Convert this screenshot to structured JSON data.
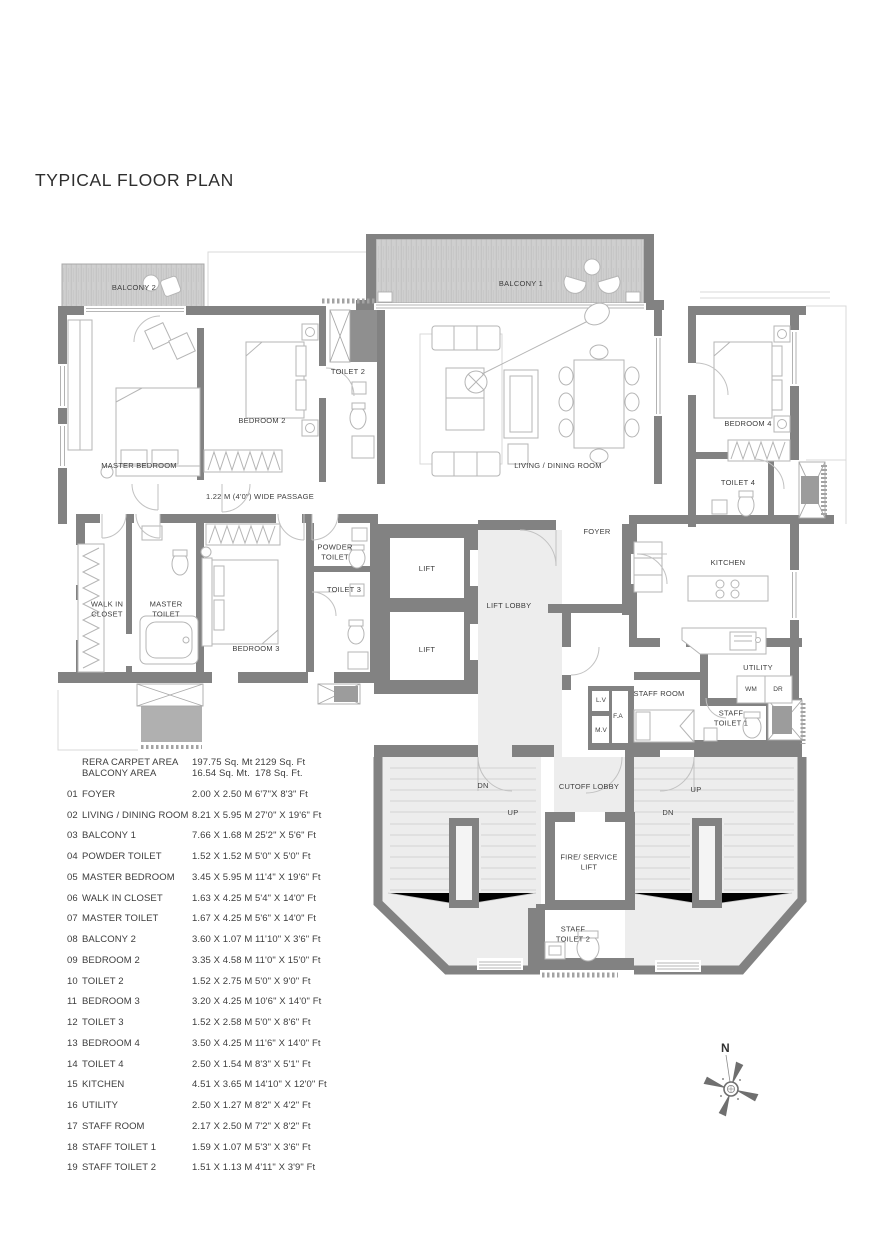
{
  "title": "TYPICAL FLOOR PLAN",
  "plan": {
    "labels": {
      "balcony2": "BALCONY 2",
      "balcony1": "BALCONY 1",
      "master_bedroom": "MASTER BEDROOM",
      "bedroom2": "BEDROOM 2",
      "toilet2": "TOILET 2",
      "living_dining": "LIVING / DINING ROOM",
      "bedroom4": "BEDROOM 4",
      "toilet4": "TOILET 4",
      "passage": "1.22 M (4'0\") WIDE PASSAGE",
      "foyer": "FOYER",
      "kitchen": "KITCHEN",
      "walk_in_closet": "WALK IN CLOSET",
      "master_toilet": "MASTER TOILET",
      "bedroom3": "BEDROOM 3",
      "powder_toilet": "POWDER TOILET",
      "toilet3": "TOILET 3",
      "lift1": "LIFT",
      "lift2": "LIFT",
      "lift_lobby": "LIFT LOBBY",
      "staff_room": "STAFF ROOM",
      "lv": "L.V",
      "fa": "F.A",
      "mv": "M.V",
      "utility": "UTILITY",
      "wm": "WM",
      "dr": "DR",
      "staff_toilet1": "STAFF TOILET 1",
      "cutoff_lobby": "CUTOFF LOBBY",
      "fire_service_lift": "FIRE/ SERVICE LIFT",
      "staff_toilet2": "STAFF TOILET 2",
      "stair_left_dn": "DN",
      "stair_left_up": "UP",
      "stair_right_up": "UP",
      "stair_right_dn": "DN"
    },
    "compass_north": "N"
  },
  "area_summary": [
    {
      "label": "RERA CARPET AREA",
      "metric": "197.75 Sq. Mt",
      "imperial": "2129 Sq. Ft"
    },
    {
      "label": "BALCONY AREA",
      "metric": "16.54 Sq. Mt.",
      "imperial": "178 Sq. Ft."
    }
  ],
  "rooms": [
    {
      "no": "01",
      "name": "FOYER",
      "metric": "2.00 X 2.50 M",
      "imperial": "6'7\"X 8'3\" Ft"
    },
    {
      "no": "02",
      "name": "LIVING / DINING ROOM",
      "metric": "8.21 X 5.95 M",
      "imperial": "27'0\" X 19'6\" Ft"
    },
    {
      "no": "03",
      "name": "BALCONY 1",
      "metric": "7.66 X 1.68 M",
      "imperial": "25'2\" X 5'6\" Ft"
    },
    {
      "no": "04",
      "name": "POWDER TOILET",
      "metric": "1.52 X 1.52 M",
      "imperial": "5'0\" X 5'0\" Ft"
    },
    {
      "no": "05",
      "name": "MASTER BEDROOM",
      "metric": "3.45 X 5.95 M",
      "imperial": "11'4\" X 19'6\" Ft"
    },
    {
      "no": "06",
      "name": "WALK IN CLOSET",
      "metric": "1.63 X 4.25 M",
      "imperial": "5'4\" X 14'0\" Ft"
    },
    {
      "no": "07",
      "name": "MASTER TOILET",
      "metric": "1.67 X 4.25 M",
      "imperial": "5'6\" X 14'0\" Ft"
    },
    {
      "no": "08",
      "name": "BALCONY 2",
      "metric": "3.60 X 1.07 M",
      "imperial": "11'10\" X 3'6\" Ft"
    },
    {
      "no": "09",
      "name": "BEDROOM 2",
      "metric": "3.35 X 4.58 M",
      "imperial": "11'0\" X 15'0\" Ft"
    },
    {
      "no": "10",
      "name": "TOILET 2",
      "metric": "1.52 X 2.75 M",
      "imperial": "5'0\" X 9'0\" Ft"
    },
    {
      "no": "11",
      "name": "BEDROOM 3",
      "metric": "3.20 X 4.25 M",
      "imperial": "10'6\" X 14'0\" Ft"
    },
    {
      "no": "12",
      "name": "TOILET 3",
      "metric": "1.52 X 2.58 M",
      "imperial": "5'0\" X 8'6\" Ft"
    },
    {
      "no": "13",
      "name": "BEDROOM 4",
      "metric": "3.50 X 4.25 M",
      "imperial": "11'6\" X 14'0\" Ft"
    },
    {
      "no": "14",
      "name": "TOILET 4",
      "metric": "2.50 X 1.54 M",
      "imperial": "8'3\" X 5'1\" Ft"
    },
    {
      "no": "15",
      "name": "KITCHEN",
      "metric": "4.51 X 3.65 M",
      "imperial": "14'10\" X 12'0\" Ft"
    },
    {
      "no": "16",
      "name": "UTILITY",
      "metric": "2.50 X 1.27 M",
      "imperial": "8'2\" X 4'2\" Ft"
    },
    {
      "no": "17",
      "name": "STAFF ROOM",
      "metric": "2.17 X 2.50 M",
      "imperial": "7'2\" X 8'2\" Ft"
    },
    {
      "no": "18",
      "name": "STAFF TOILET 1",
      "metric": "1.59 X 1.07 M",
      "imperial": "5'3\" X 3'6\" Ft"
    },
    {
      "no": "19",
      "name": "STAFF TOILET 2",
      "metric": "1.51 X 1.13 M",
      "imperial": "4'11\" X 3'9\" Ft"
    }
  ],
  "colors": {
    "wall": "#828282",
    "light_fill": "#ededed",
    "hatch": "#cfcfcf",
    "text": "#3d3d3d"
  }
}
